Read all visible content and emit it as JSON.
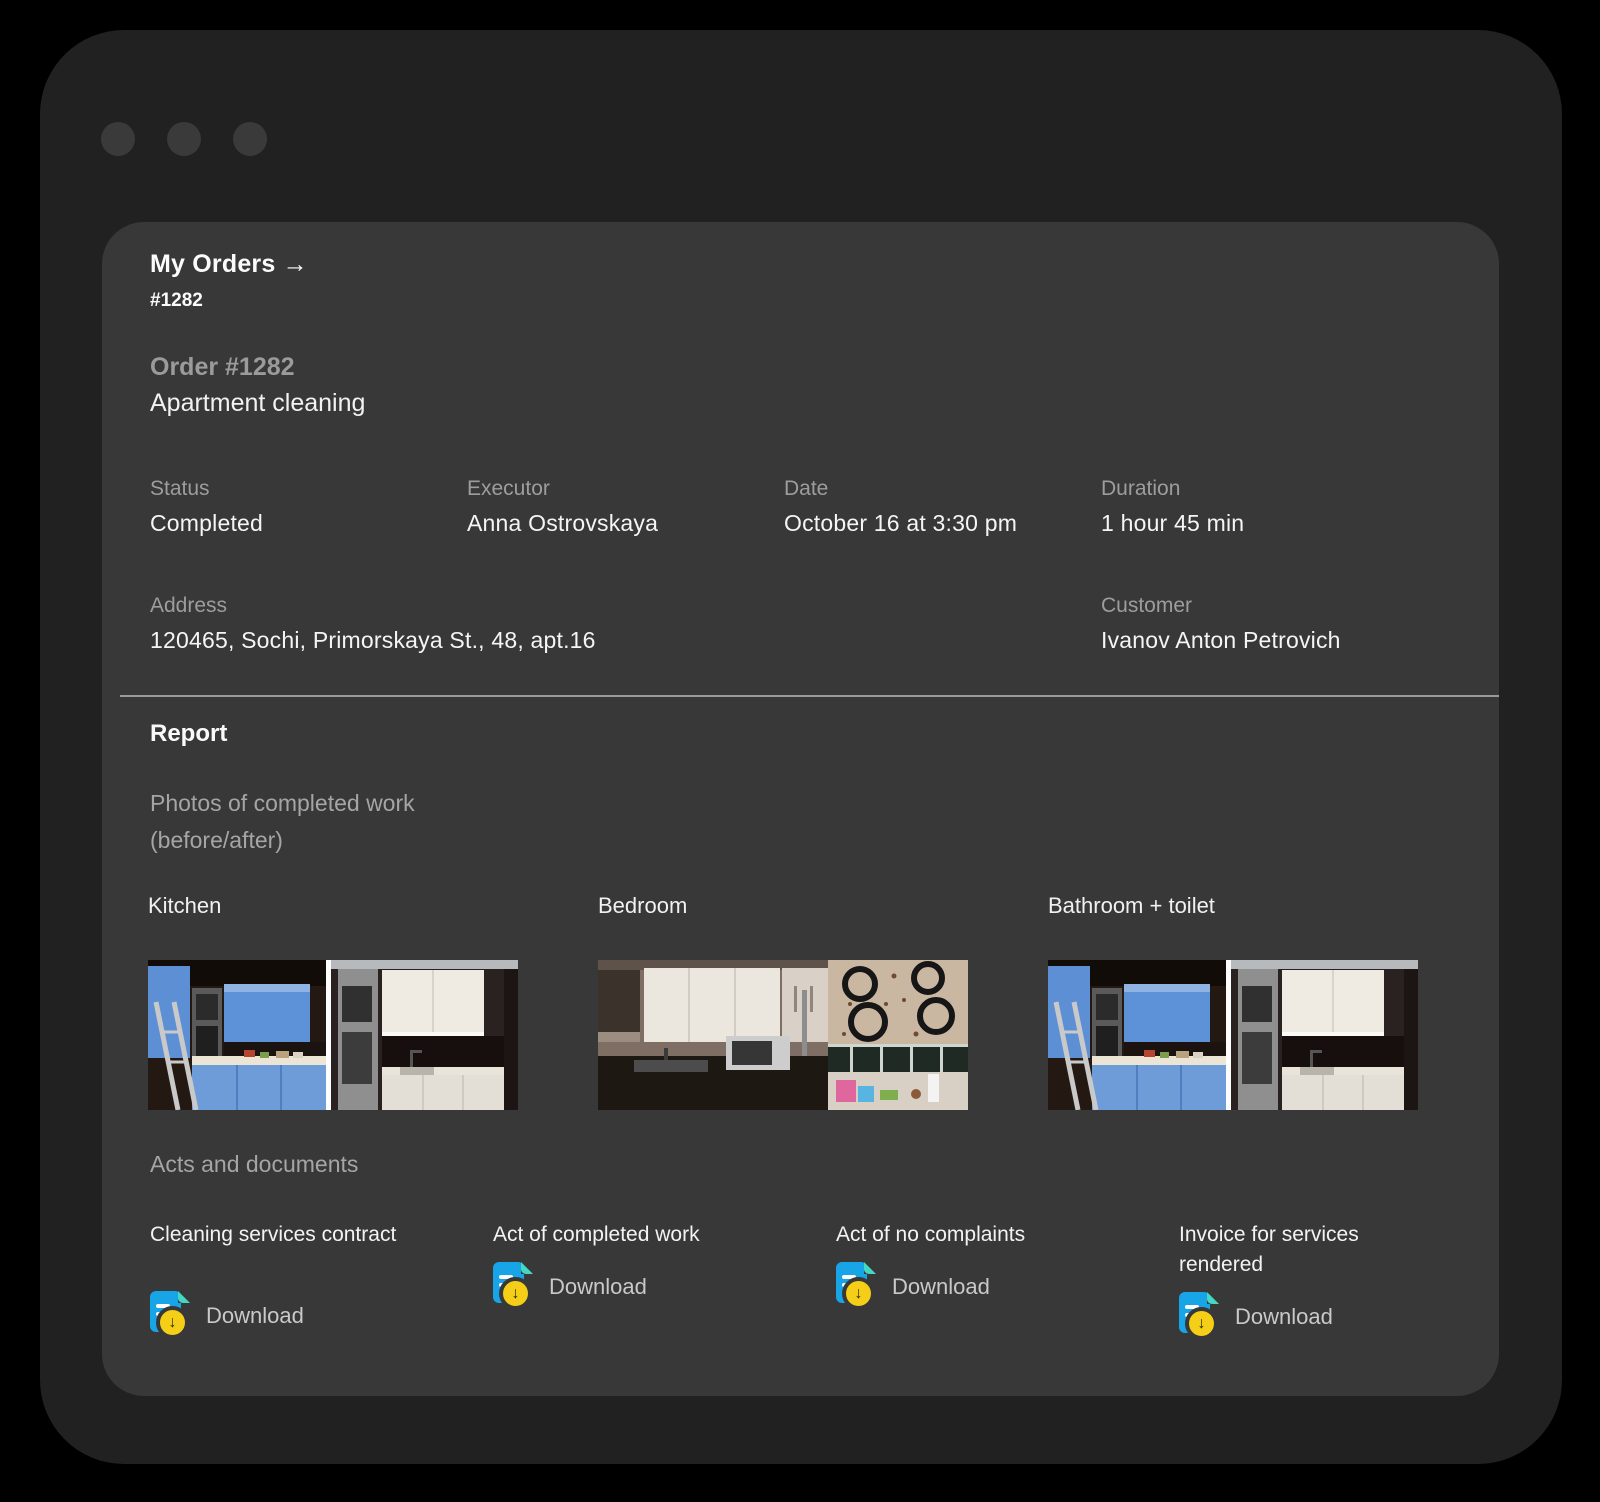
{
  "window": {
    "dots": [
      "window-dot-1",
      "window-dot-2",
      "window-dot-3"
    ]
  },
  "breadcrumb": {
    "title": "My Orders →",
    "order_id": "#1282"
  },
  "order": {
    "number_label": "Order #1282",
    "service": "Apartment cleaning"
  },
  "info": {
    "fields": [
      {
        "label": "Status",
        "value": "Completed"
      },
      {
        "label": "Executor",
        "value": "Anna Ostrovskaya"
      },
      {
        "label": "Date",
        "value": "October 16 at 3:30 pm"
      },
      {
        "label": "Duration",
        "value": "1 hour 45 min"
      }
    ],
    "address": {
      "label": "Address",
      "value": "120465, Sochi, Primorskaya St., 48, apt.16"
    },
    "customer": {
      "label": "Customer",
      "value": "Ivanov Anton Petrovich"
    }
  },
  "report": {
    "title": "Report",
    "photos_caption_line1": "Photos of completed work",
    "photos_caption_line2": "(before/after)",
    "rooms": [
      {
        "label": "Kitchen"
      },
      {
        "label": "Bedroom"
      },
      {
        "label": "Bathroom + toilet"
      }
    ],
    "documents_caption": "Acts and documents",
    "documents": [
      {
        "title": "Cleaning services contract",
        "action": "Download"
      },
      {
        "title": "Act of completed work",
        "action": "Download"
      },
      {
        "title": "Act of no complaints",
        "action": "Download"
      },
      {
        "title": "Invoice for services rendered",
        "action": "Download"
      }
    ]
  },
  "icons": {
    "download_arrow": "↓"
  },
  "colors": {
    "page_bg": "#000000",
    "window_bg": "#212121",
    "card_bg": "#383838",
    "label_gray": "#9d9d9d",
    "text_white": "#f5f5f5",
    "doc_icon_blue": "#18a5e8",
    "doc_icon_fold_teal": "#43d8c3",
    "doc_badge_yellow": "#f4ce17"
  }
}
